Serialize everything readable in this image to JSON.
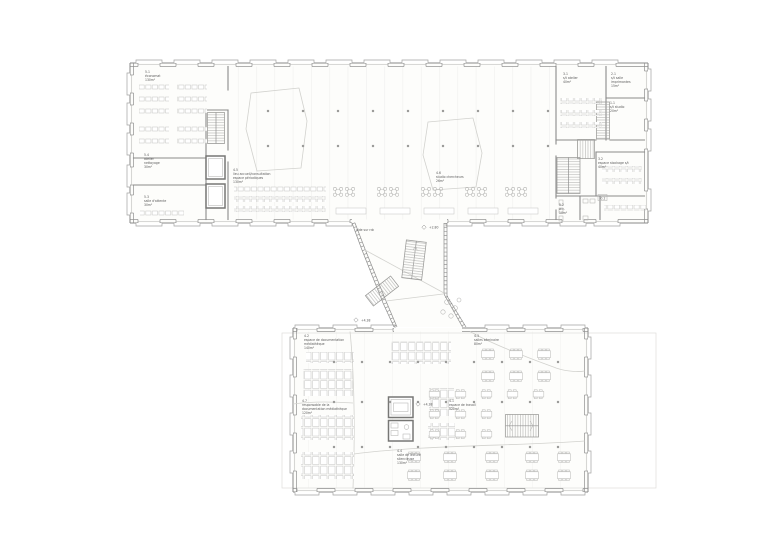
{
  "rooms": {
    "economat": {
      "code": "5.1",
      "name": "économat",
      "area": "130m²"
    },
    "atelier": {
      "code": "5.4",
      "name": "atelier",
      "name2": "nettoyage",
      "area": "30m²"
    },
    "attente": {
      "code": "5.3",
      "name": "salle d'attente",
      "area": "30m²"
    },
    "accueil": {
      "code": "4.5",
      "name": "lieu accueil/consultation",
      "name2": "espace périodiques",
      "area": "130m²"
    },
    "studio_chercheurs": {
      "code": "4.6",
      "name": "studio chercheurs",
      "area": "26m²"
    },
    "st_atelier": {
      "code": "3.1",
      "name": "s/t atelier",
      "area": "40m²"
    },
    "st_imprimantes": {
      "code": "2.1",
      "name": "s/t salle",
      "name2": "imprimantes",
      "area": "15m²"
    },
    "st_studio": {
      "code": "1.1",
      "name": "s/t studio",
      "area": "20m²"
    },
    "stockage": {
      "code": "3.2",
      "name": "espace stockage s/t",
      "area": "40m²"
    },
    "wc": {
      "code": "5.2",
      "name": "w.c.",
      "area": "10m²"
    },
    "documentation": {
      "code": "4.2",
      "name": "espace de documentation",
      "name2": "médiathèque",
      "area": "140m²"
    },
    "seminaire": {
      "code": "4.3",
      "name": "salles séminaire",
      "area": "80m²"
    },
    "responsable": {
      "code": "4.7",
      "name": "responsable de la",
      "name2": "documentation médiathèque",
      "area": "120m²"
    },
    "travail": {
      "code": "4.1",
      "name": "espace de travail",
      "area": "520m²"
    },
    "lecture": {
      "code": "4.4",
      "name": "salle de lecture",
      "name2": "silencieuse",
      "area": "130m²"
    }
  },
  "annotations": {
    "void_note": "vide sur rdc",
    "level_upper": "+2.80",
    "level_lower": "+4.38",
    "level_core": "+4.38",
    "door_tag": "0.2"
  },
  "colors": {
    "wall_line": "#8a8a8a",
    "furniture_line": "#bdbdbb",
    "detail_line": "#c4c4c2",
    "text": "#5a5a5a",
    "background": "#ffffff"
  }
}
